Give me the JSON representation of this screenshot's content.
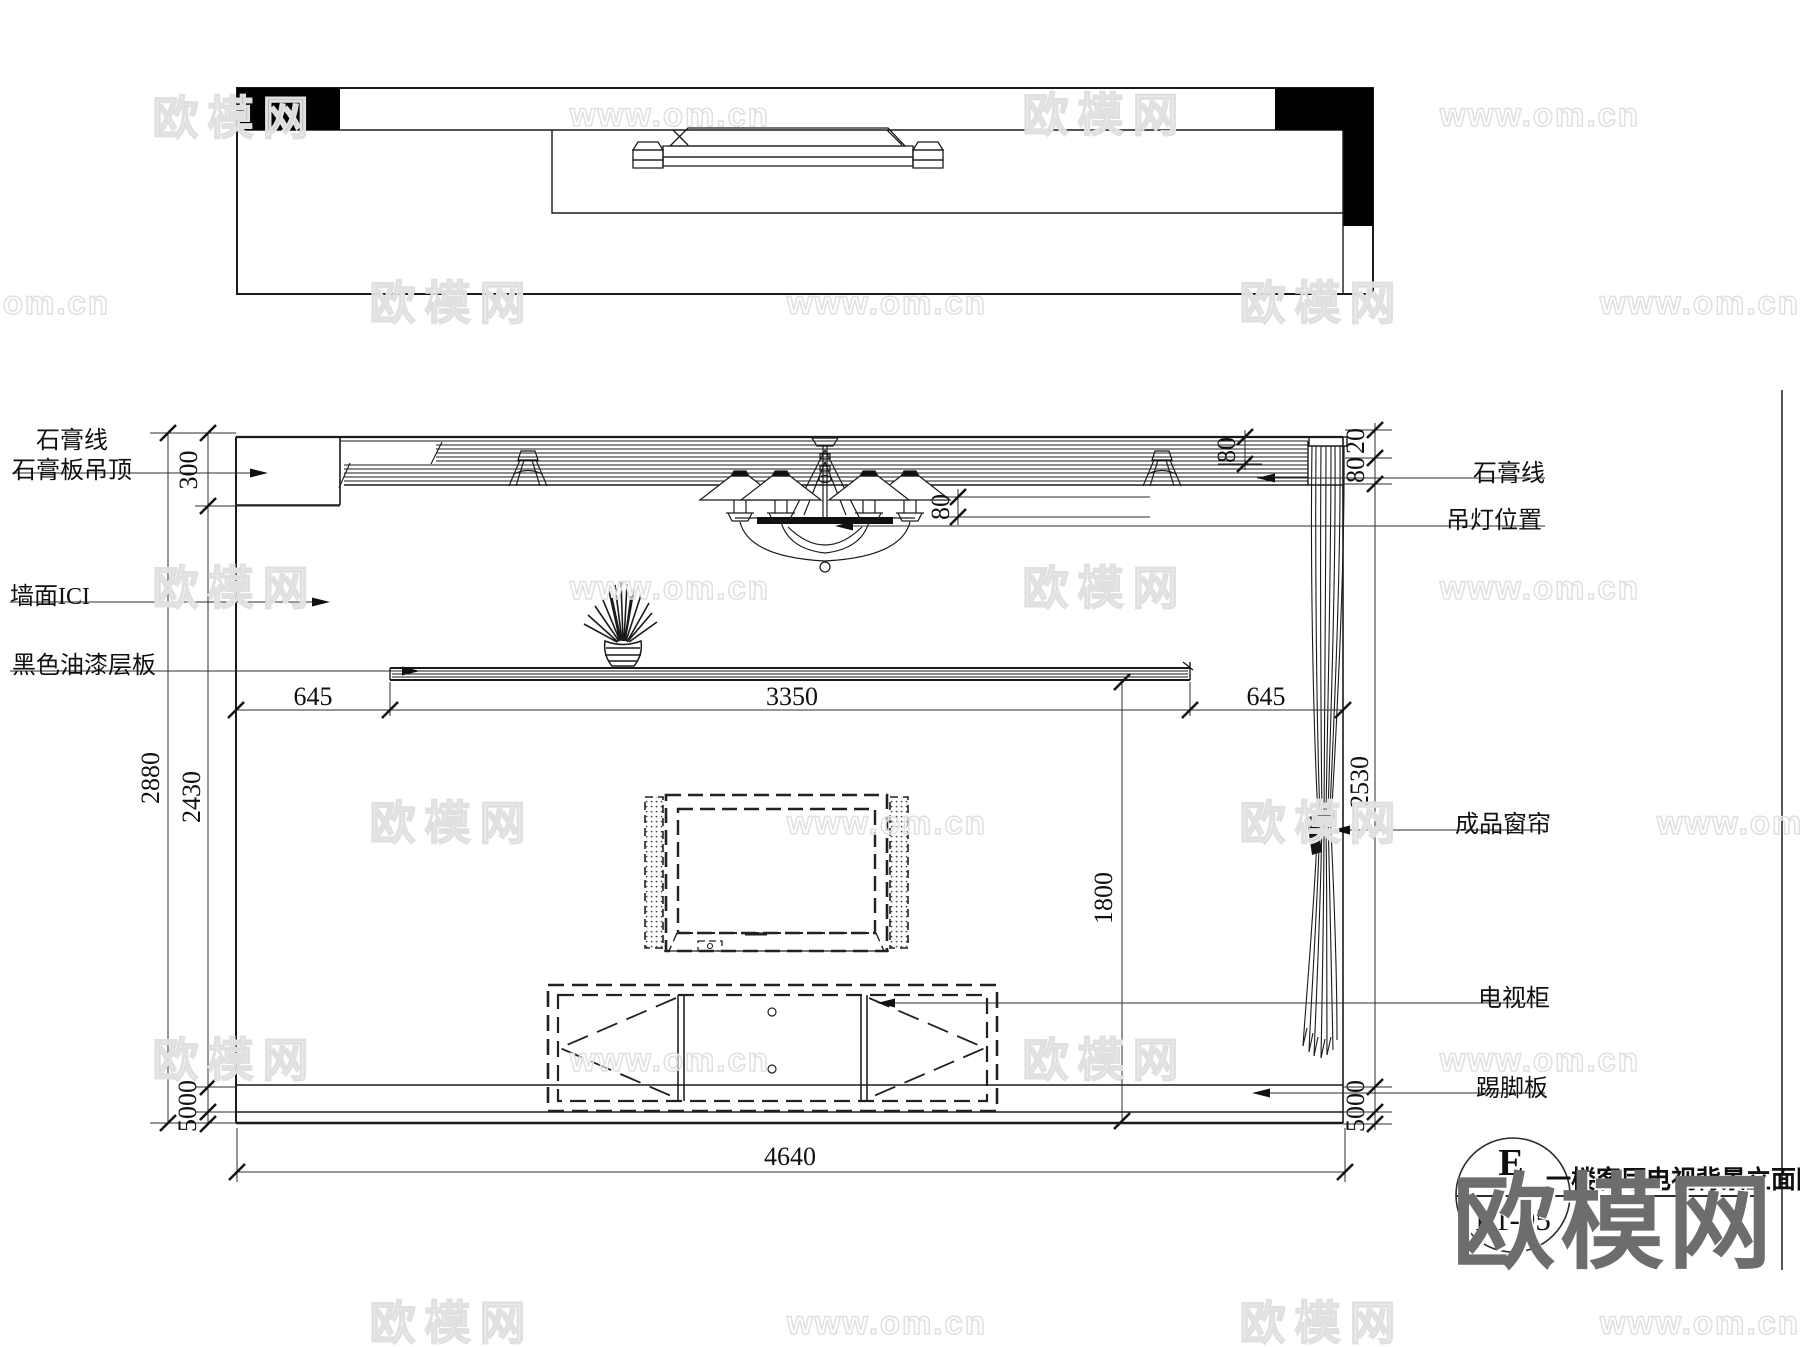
{
  "labels": {
    "plaster_line_left": "石膏线",
    "gypsum_board_ceiling": "石膏板吊顶",
    "wall_ici": "墙面ICI",
    "black_paint_shelf": "黑色油漆层板",
    "plaster_line_right": "石膏线",
    "pendant_lamp_position": "吊灯位置",
    "finished_curtain": "成品窗帘",
    "tv_cabinet": "电视柜",
    "skirting_board": "踢脚板"
  },
  "dimensions": {
    "ceiling_drop": "300",
    "total_height": "2880",
    "inner_height": "2430",
    "left_offset": "645",
    "shelf_length": "3350",
    "right_offset": "645",
    "lamp_drop": "80",
    "crown_height_right": "80",
    "crown_top_gap": "20",
    "curtain_height": "2530",
    "tv_height": "1800",
    "skirting_left": "5000",
    "skirting_right": "5000",
    "total_width": "4640"
  },
  "title_block": {
    "detail_letter": "E",
    "sheet_code": "L1-05",
    "drawing_title": "一楼客厅电视背景立面图"
  },
  "watermarks": {
    "brand_logo": "欧模网",
    "site_url": "www.om.cn",
    "items": [
      {
        "x": 235,
        "y": 115,
        "text": "欧模网",
        "kind": "brand"
      },
      {
        "x": 670,
        "y": 115,
        "text": "www.om.cn",
        "kind": "site"
      },
      {
        "x": 1105,
        "y": 112,
        "text": "欧模网",
        "kind": "brand"
      },
      {
        "x": 1540,
        "y": 115,
        "text": "www.om.cn",
        "kind": "site"
      },
      {
        "x": 10,
        "y": 303,
        "text": "www.om.cn",
        "kind": "site"
      },
      {
        "x": 452,
        "y": 300,
        "text": "欧模网",
        "kind": "brand"
      },
      {
        "x": 887,
        "y": 303,
        "text": "www.om.cn",
        "kind": "site"
      },
      {
        "x": 1322,
        "y": 300,
        "text": "欧模网",
        "kind": "brand"
      },
      {
        "x": 1700,
        "y": 303,
        "text": "www.om.cn",
        "kind": "site"
      },
      {
        "x": 235,
        "y": 585,
        "text": "欧模网",
        "kind": "brand"
      },
      {
        "x": 670,
        "y": 588,
        "text": "www.om.cn",
        "kind": "site"
      },
      {
        "x": 1105,
        "y": 585,
        "text": "欧模网",
        "kind": "brand"
      },
      {
        "x": 1540,
        "y": 588,
        "text": "www.om.cn",
        "kind": "site"
      },
      {
        "x": 452,
        "y": 820,
        "text": "欧模网",
        "kind": "brand"
      },
      {
        "x": 887,
        "y": 823,
        "text": "www.om.cn",
        "kind": "site"
      },
      {
        "x": 1322,
        "y": 820,
        "text": "欧模网",
        "kind": "brand"
      },
      {
        "x": 1757,
        "y": 823,
        "text": "www.om.cn",
        "kind": "site"
      },
      {
        "x": 235,
        "y": 1057,
        "text": "欧模网",
        "kind": "brand"
      },
      {
        "x": 670,
        "y": 1060,
        "text": "www.om.cn",
        "kind": "site"
      },
      {
        "x": 1105,
        "y": 1057,
        "text": "欧模网",
        "kind": "brand"
      },
      {
        "x": 1540,
        "y": 1060,
        "text": "www.om.cn",
        "kind": "site"
      },
      {
        "x": 452,
        "y": 1320,
        "text": "欧模网",
        "kind": "brand"
      },
      {
        "x": 887,
        "y": 1323,
        "text": "www.om.cn",
        "kind": "site"
      },
      {
        "x": 1322,
        "y": 1320,
        "text": "欧模网",
        "kind": "brand"
      },
      {
        "x": 1700,
        "y": 1323,
        "text": "www.om.cn",
        "kind": "site"
      }
    ]
  }
}
